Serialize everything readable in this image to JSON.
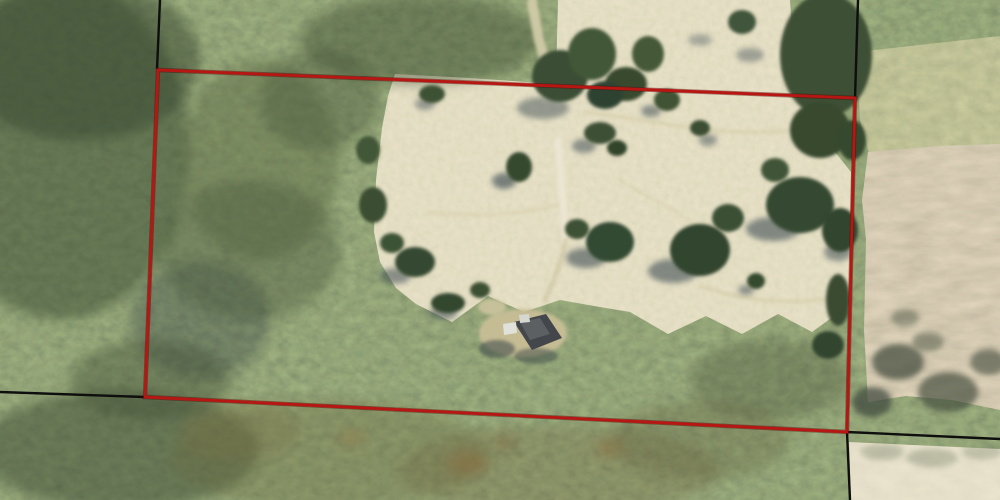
{
  "view": {
    "description": "Aerial imagery of a rural property with a highlighted parcel boundary, surrounded by forest, pasture and plowed fields",
    "width": 1000,
    "height": 500
  },
  "overlay": {
    "parcel_boundary": {
      "color": "#b81612",
      "underlay_color": "#550503",
      "width": 2.8,
      "points": [
        [
          158,
          70
        ],
        [
          855,
          98
        ],
        [
          847,
          432
        ],
        [
          145,
          397
        ]
      ]
    },
    "adjacent_boundaries": {
      "color": "#0e0e0e",
      "width": 2.4,
      "segments": [
        [
          160,
          0,
          157,
          69
        ],
        [
          858,
          0,
          855,
          98
        ],
        [
          0,
          392,
          145,
          397
        ],
        [
          847,
          432,
          1000,
          439
        ],
        [
          847,
          432,
          850,
          500
        ]
      ]
    }
  },
  "terrain": {
    "base": {
      "name": "forest-canopy",
      "color": "#4a5a38"
    },
    "regions": [
      {
        "name": "pasture",
        "texture": "pasture",
        "points": "395,74 470,78 540,83 556,77 558,0 790,0 794,62 797,96 812,120 835,152 851,172 850,250 849,310 834,316 812,332 778,314 742,334 706,316 668,334 630,312 594,306 560,300 524,312 488,296 452,322 416,304 396,288 380,262 374,232 376,180 382,128 388,96"
      },
      {
        "name": "scrub-field",
        "texture": "scrub",
        "points": "856,52 1000,36 1000,158 940,150 872,164 860,120"
      },
      {
        "name": "plowed-field",
        "texture": "farmland",
        "points": "868,152 940,146 1000,144 1000,410 952,400 906,396 868,402 864,330 866,240 862,200"
      },
      {
        "name": "bright-field",
        "texture": "bright",
        "points": "849,442 1000,449 1000,500 851,500"
      }
    ],
    "patches": [
      [
        60,
        150,
        130,
        170,
        "#3e4f35",
        0.55
      ],
      [
        80,
        60,
        120,
        80,
        "#36452e",
        0.5
      ],
      [
        260,
        160,
        80,
        100,
        "#5a6742",
        0.45
      ],
      [
        200,
        320,
        70,
        60,
        "#314141",
        0.35
      ],
      [
        320,
        100,
        60,
        50,
        "#46563a",
        0.4
      ],
      [
        420,
        40,
        120,
        45,
        "#3d4d33",
        0.45
      ],
      [
        120,
        450,
        140,
        60,
        "#3a4a30",
        0.5
      ],
      [
        330,
        455,
        160,
        55,
        "#6b6a41",
        0.35
      ],
      [
        560,
        470,
        160,
        45,
        "#6f6540",
        0.3
      ],
      [
        770,
        380,
        80,
        40,
        "#4a5338",
        0.35
      ],
      [
        240,
        430,
        60,
        30,
        "#7c7347",
        0.3
      ],
      [
        700,
        440,
        90,
        40,
        "#5d5c3a",
        0.3
      ],
      [
        468,
        463,
        20,
        12,
        "#8a6b3c",
        0.5
      ],
      [
        610,
        448,
        15,
        9,
        "#8f6f40",
        0.45
      ],
      [
        352,
        438,
        13,
        8,
        "#95713f",
        0.4
      ],
      [
        505,
        442,
        12,
        8,
        "#7f6038",
        0.4
      ],
      [
        250,
        250,
        90,
        70,
        "#47573b",
        0.4
      ],
      [
        150,
        380,
        80,
        40,
        "#3c4c32",
        0.4
      ]
    ],
    "trails": [
      {
        "name": "driveway",
        "d": "M558,140 L562,190 L566,240",
        "c": "#ece5d2",
        "w": 7,
        "o": 1
      },
      {
        "name": "driveway-upper",
        "d": "M532,2 L539,40 L546,64",
        "c": "#d9d0ae",
        "w": 10,
        "o": 0.85
      },
      {
        "name": "driveway-lower",
        "d": "M566,240 C560,268 552,284 545,300",
        "c": "#cfc7a2",
        "w": 5,
        "o": 0.7
      },
      {
        "name": "trail",
        "d": "M585,112 C660,122 725,138 792,130",
        "c": "#d2caa2",
        "w": 4,
        "o": 0.5
      },
      {
        "name": "trail",
        "d": "M700,286 C748,302 795,306 846,296",
        "c": "#d0c8a0",
        "w": 4,
        "o": 0.5
      },
      {
        "name": "trail",
        "d": "M430,212 C475,218 520,214 556,206",
        "c": "#d2caa2",
        "w": 4,
        "o": 0.4
      },
      {
        "name": "trail",
        "d": "M620,180 C650,200 680,210 700,230",
        "c": "#cfc7a0",
        "w": 3,
        "o": 0.35
      }
    ],
    "shadows": [
      [
        504,
        181,
        12,
        8,
        0.6
      ],
      [
        586,
        258,
        20,
        10,
        0.55
      ],
      [
        673,
        271,
        25,
        12,
        0.55
      ],
      [
        773,
        229,
        27,
        12,
        0.55
      ],
      [
        395,
        276,
        16,
        8,
        0.5
      ],
      [
        584,
        146,
        12,
        7,
        0.5
      ],
      [
        543,
        108,
        26,
        11,
        0.45
      ],
      [
        651,
        111,
        10,
        6,
        0.5
      ],
      [
        425,
        104,
        10,
        6,
        0.45
      ],
      [
        708,
        140,
        9,
        6,
        0.45
      ],
      [
        838,
        252,
        14,
        9,
        0.5
      ],
      [
        443,
        313,
        14,
        7,
        0.5
      ],
      [
        746,
        290,
        8,
        5,
        0.5
      ],
      [
        750,
        55,
        14,
        7,
        0.4
      ],
      [
        700,
        40,
        12,
        6,
        0.35
      ],
      [
        898,
        362,
        26,
        18,
        0.7,
        "#3f4a3b"
      ],
      [
        948,
        392,
        30,
        20,
        0.65,
        "#414a3b"
      ],
      [
        872,
        402,
        20,
        15,
        0.7,
        "#3a453a"
      ],
      [
        988,
        362,
        18,
        13,
        0.6,
        "#3f4a3b"
      ],
      [
        928,
        342,
        16,
        10,
        0.5,
        "#4a5340"
      ],
      [
        905,
        318,
        14,
        9,
        0.45,
        "#4a5340"
      ],
      [
        882,
        452,
        22,
        8,
        0.35,
        "#6e7a62"
      ],
      [
        932,
        458,
        26,
        9,
        0.35,
        "#6e7a62"
      ],
      [
        982,
        452,
        20,
        8,
        0.3,
        "#6e7a62"
      ]
    ],
    "trees": [
      [
        560,
        76,
        28,
        26,
        "#3a4e34"
      ],
      [
        592,
        54,
        24,
        26,
        "#425638"
      ],
      [
        626,
        84,
        21,
        17,
        "#37492f"
      ],
      [
        648,
        54,
        16,
        18,
        "#445837"
      ],
      [
        605,
        95,
        18,
        14,
        "#2f4230"
      ],
      [
        742,
        22,
        14,
        12,
        "#41553a"
      ],
      [
        826,
        55,
        46,
        62,
        "#3c4f36"
      ],
      [
        820,
        130,
        30,
        28,
        "#37482f"
      ],
      [
        852,
        140,
        14,
        20,
        "#36482f"
      ],
      [
        432,
        94,
        13,
        9,
        "#3d5134"
      ],
      [
        519,
        167,
        13,
        15,
        "#35492f"
      ],
      [
        600,
        133,
        16,
        11,
        "#3c5034"
      ],
      [
        617,
        148,
        10,
        8,
        "#33452c"
      ],
      [
        667,
        100,
        13,
        11,
        "#3f5336"
      ],
      [
        700,
        128,
        10,
        8,
        "#3a4e32"
      ],
      [
        610,
        242,
        24,
        20,
        "#334830"
      ],
      [
        577,
        229,
        12,
        10,
        "#3d5136"
      ],
      [
        700,
        250,
        30,
        26,
        "#31452e"
      ],
      [
        728,
        218,
        16,
        14,
        "#3b4f34"
      ],
      [
        800,
        205,
        34,
        28,
        "#354931"
      ],
      [
        775,
        170,
        14,
        12,
        "#405438"
      ],
      [
        840,
        230,
        18,
        22,
        "#31442d"
      ],
      [
        756,
        281,
        9,
        8,
        "#35492f"
      ],
      [
        838,
        300,
        12,
        26,
        "#3a4c33"
      ],
      [
        828,
        345,
        16,
        14,
        "#33452d"
      ],
      [
        415,
        262,
        20,
        15,
        "#364a30"
      ],
      [
        392,
        243,
        12,
        10,
        "#3e5236"
      ],
      [
        448,
        303,
        17,
        10,
        "#33462e"
      ],
      [
        480,
        290,
        10,
        8,
        "#3c5033"
      ],
      [
        373,
        205,
        14,
        18,
        "#3a4d33"
      ],
      [
        368,
        150,
        12,
        14,
        "#425639"
      ]
    ]
  },
  "structures": {
    "house": {
      "shapes": [
        {
          "t": "ellipse",
          "n": "house-clearing",
          "a": [
            523,
            333,
            44,
            24
          ],
          "c": "#c8be96",
          "o": 0.95
        },
        {
          "t": "ellipse",
          "n": "driveway-pad",
          "a": [
            492,
            307,
            14,
            8
          ],
          "c": "#cfc6a0",
          "o": 0.85
        },
        {
          "t": "ellipse",
          "n": "house-shadow",
          "a": [
            497,
            349,
            18,
            9
          ],
          "c": "#2e3a40",
          "o": 0.5
        },
        {
          "t": "ellipse",
          "n": "house-shadow",
          "a": [
            536,
            356,
            22,
            8
          ],
          "c": "#2e3a40",
          "o": 0.45
        },
        {
          "t": "poly",
          "n": "house-roof",
          "p": "514,322 546,314 562,338 532,350",
          "c": "#43464a",
          "o": 1
        },
        {
          "t": "poly",
          "n": "house-roof-ridge",
          "p": "520,322 540,318 550,334 530,340",
          "c": "#5c6062",
          "o": 1
        },
        {
          "t": "poly",
          "n": "outbuilding",
          "p": "503,324 516,322 517,333 504,335",
          "c": "#e0e1db",
          "o": 1
        },
        {
          "t": "poly",
          "n": "outbuilding",
          "p": "519,315 529,314 530,322 520,323",
          "c": "#d6d7d1",
          "o": 1
        }
      ]
    }
  }
}
